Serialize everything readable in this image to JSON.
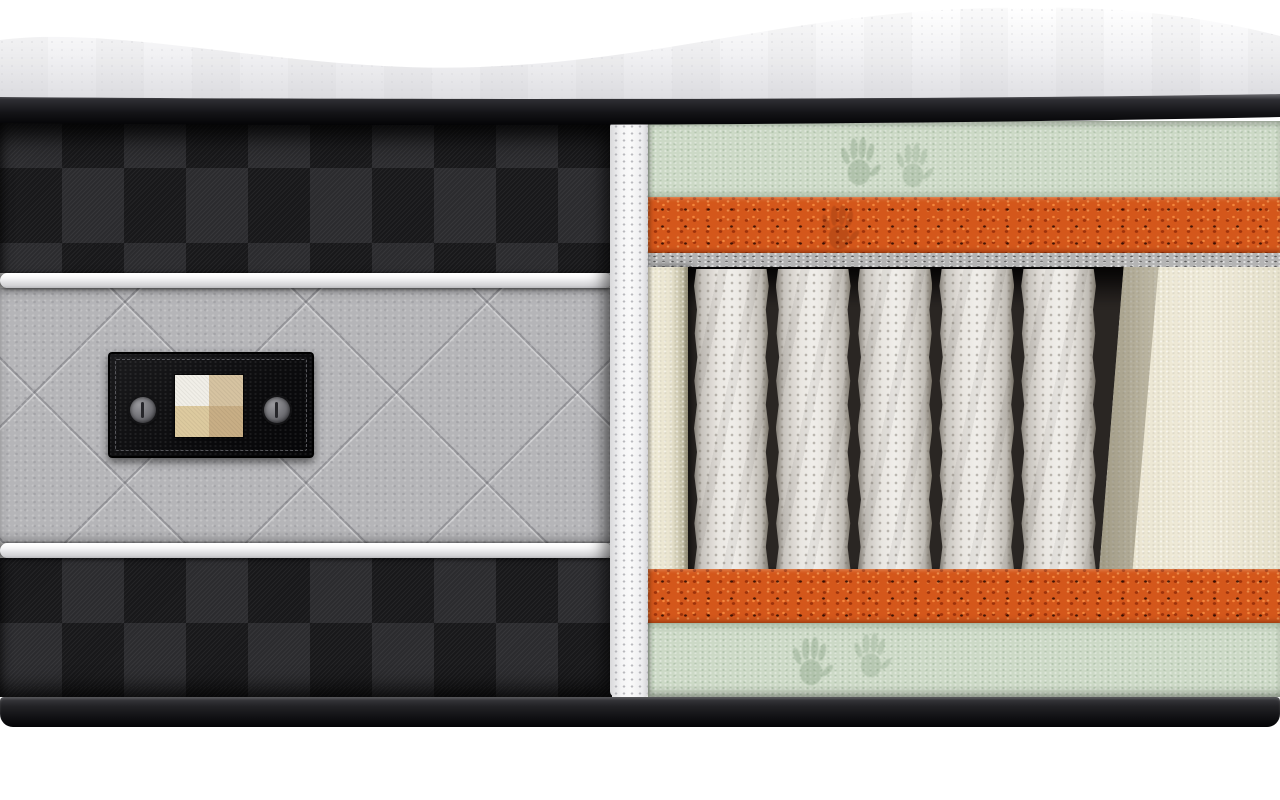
{
  "scene": {
    "description": "3D cutaway render of a hybrid pocket-spring mattress showing internal layers",
    "page_background": "#ffffff"
  },
  "colors": {
    "page_bg": "#ffffff",
    "top_fabric": "#f2f2f4",
    "top_fabric_shade": "#e0e0e4",
    "piping_dark": "#141417",
    "checker_dark": "#18181a",
    "checker_light": "#2b2b2e",
    "piping_white": "#f2f2f3",
    "quilt_gray": "#b5b5b8",
    "label_black": "#0c0c0e",
    "swatch": [
      "#f1efe8",
      "#d6c3a1",
      "#ddca9f",
      "#c8ae85"
    ],
    "cut_fabric": "#efeff0",
    "memory_foam_green": "#ccd9c6",
    "support_foam_orange": "#d4571b",
    "felt_gray": "#b4b4b4",
    "encasement_cream": "#e9e4cf",
    "spring_fabric": "#f0eeea",
    "cavity_shadow": "#2a2623",
    "base_dark": "#161618"
  },
  "layers": [
    {
      "name": "quilted-top-cover"
    },
    {
      "name": "black-piping"
    },
    {
      "name": "memory-foam-green-top"
    },
    {
      "name": "support-foam-orange-top"
    },
    {
      "name": "felt-pad-top"
    },
    {
      "name": "pocket-spring-core"
    },
    {
      "name": "foam-encasement"
    },
    {
      "name": "felt-pad-bottom"
    },
    {
      "name": "support-foam-orange-bottom"
    },
    {
      "name": "memory-foam-green-bottom"
    },
    {
      "name": "base-border"
    }
  ],
  "side_panel": {
    "fabric": "black-checkered-twill",
    "band": "gray-diamond-quilt",
    "label": {
      "button_count": 2,
      "swatch_rows": 2,
      "swatch_cols": 2
    }
  },
  "springs": {
    "count": 5
  },
  "handprints": {
    "top_green": 2,
    "bottom_green": 2,
    "orange_top": 1
  }
}
